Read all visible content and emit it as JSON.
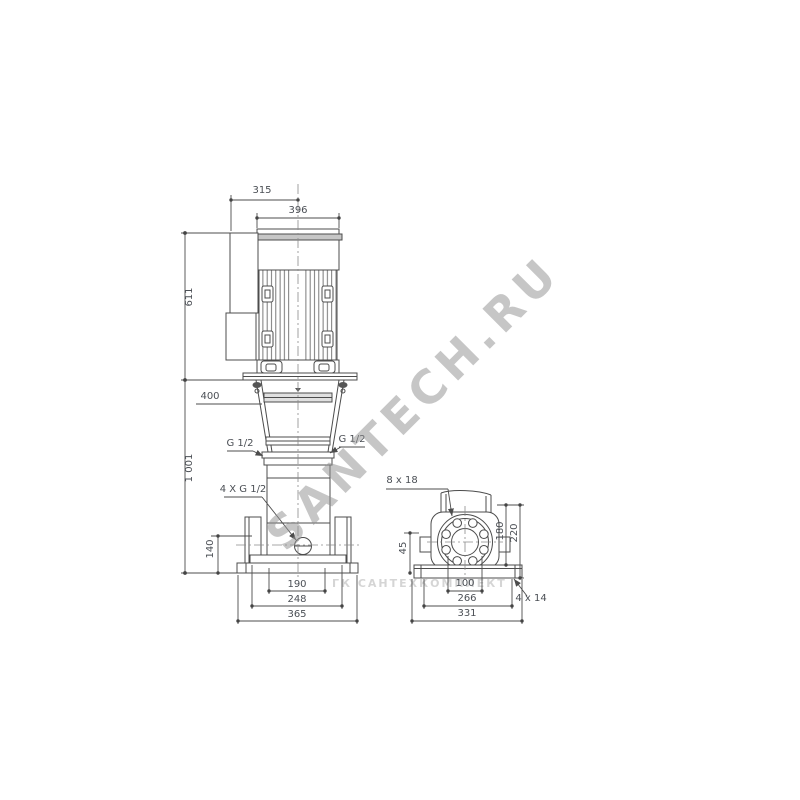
{
  "watermarks": {
    "diagonal": "SANTECH.RU",
    "horizontal": "ГК САНТЕХКОМПЛЕКТ"
  },
  "front_view": {
    "dims": {
      "terminal_box_offset": "315",
      "motor_width": "396",
      "motor_height": "611",
      "removal_clearance": "400",
      "total_height": "1 001",
      "port_center_height": "140",
      "base_inner_width": "190",
      "base_mid_width": "248",
      "base_width": "365",
      "port_left": "G 1/2",
      "port_right": "G 1/2",
      "ports_4x": "4 X G 1/2"
    }
  },
  "side_view": {
    "dims": {
      "flange_holes": "8 x 18",
      "base_edge_height": "45",
      "hole_span": "100",
      "base_mid_width": "266",
      "base_width": "331",
      "base_holes": "4 x 14",
      "flange_height": "180",
      "flange_top_height": "220"
    }
  }
}
